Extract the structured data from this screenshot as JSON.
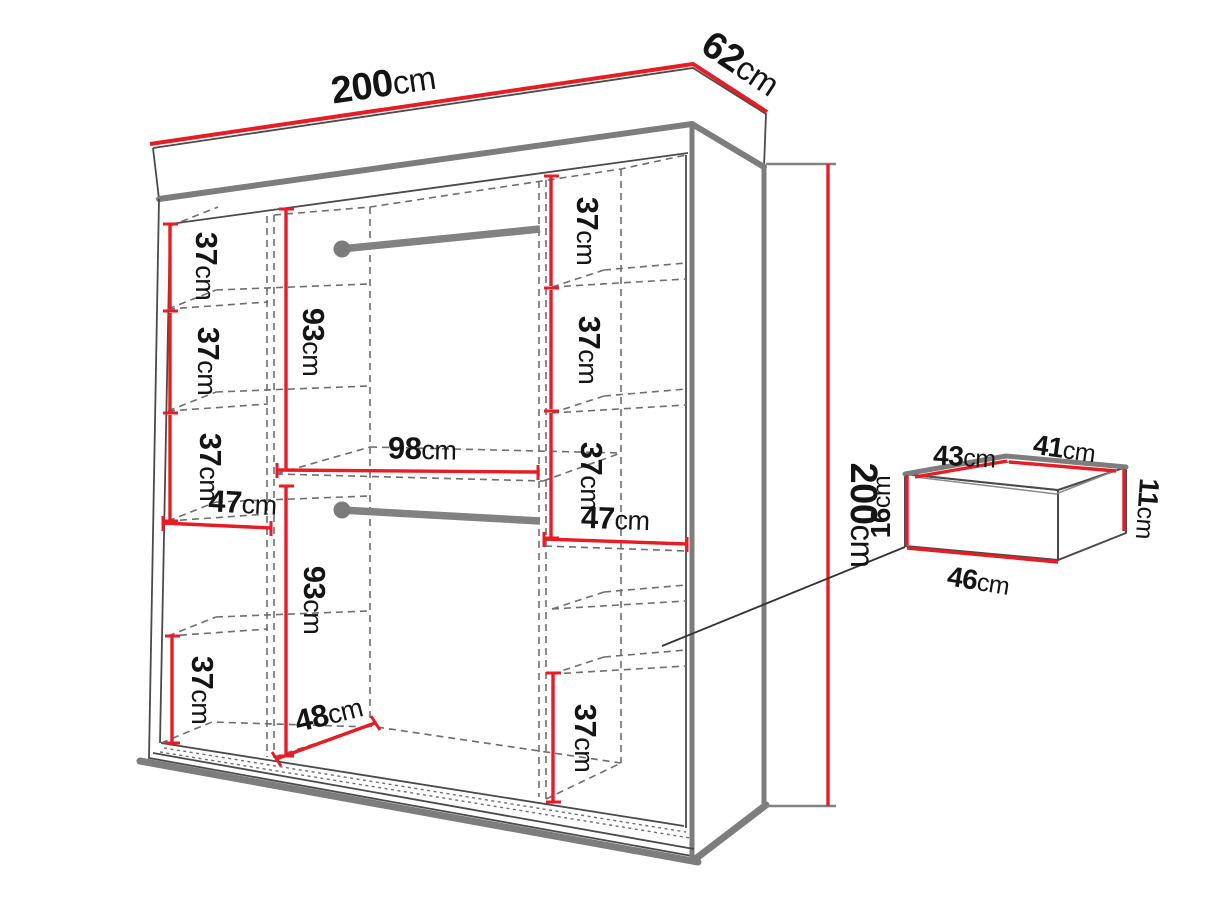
{
  "diagram": {
    "kind": "wardrobe-dimension-diagram",
    "colors": {
      "dimension_red": "#e81c24",
      "edge_gray": "#7d7d7d",
      "outline": "#4a4a4a",
      "dashed_gray": "#6e6e6e",
      "text": "#141414",
      "background": "#ffffff"
    },
    "labels": {
      "top_width": {
        "num": "200",
        "unit": "cm"
      },
      "top_depth": {
        "num": "62",
        "unit": "cm"
      },
      "right_height": {
        "num": "200",
        "unit": "cm"
      },
      "left_shelf_1": {
        "num": "37",
        "unit": "cm"
      },
      "left_shelf_2": {
        "num": "37",
        "unit": "cm"
      },
      "left_shelf_3": {
        "num": "37",
        "unit": "cm"
      },
      "left_col_width": {
        "num": "47",
        "unit": "cm"
      },
      "left_bottom": {
        "num": "37",
        "unit": "cm"
      },
      "mid_hang_top": {
        "num": "93",
        "unit": "cm"
      },
      "mid_hang_bottom": {
        "num": "93",
        "unit": "cm"
      },
      "mid_width": {
        "num": "98",
        "unit": "cm"
      },
      "mid_depth": {
        "num": "48",
        "unit": "cm"
      },
      "right_shelf_1": {
        "num": "37",
        "unit": "cm"
      },
      "right_shelf_2": {
        "num": "37",
        "unit": "cm"
      },
      "right_shelf_3": {
        "num": "37",
        "unit": "cm"
      },
      "right_col_width": {
        "num": "47",
        "unit": "cm"
      },
      "right_bottom": {
        "num": "37",
        "unit": "cm"
      },
      "drawer_side_top": {
        "num": "43",
        "unit": "cm"
      },
      "drawer_back_top": {
        "num": "41",
        "unit": "cm"
      },
      "drawer_front_h": {
        "num": "16",
        "unit": "cm"
      },
      "drawer_back_h": {
        "num": "11",
        "unit": "cm"
      },
      "drawer_front_w": {
        "num": "46",
        "unit": "cm"
      }
    }
  }
}
